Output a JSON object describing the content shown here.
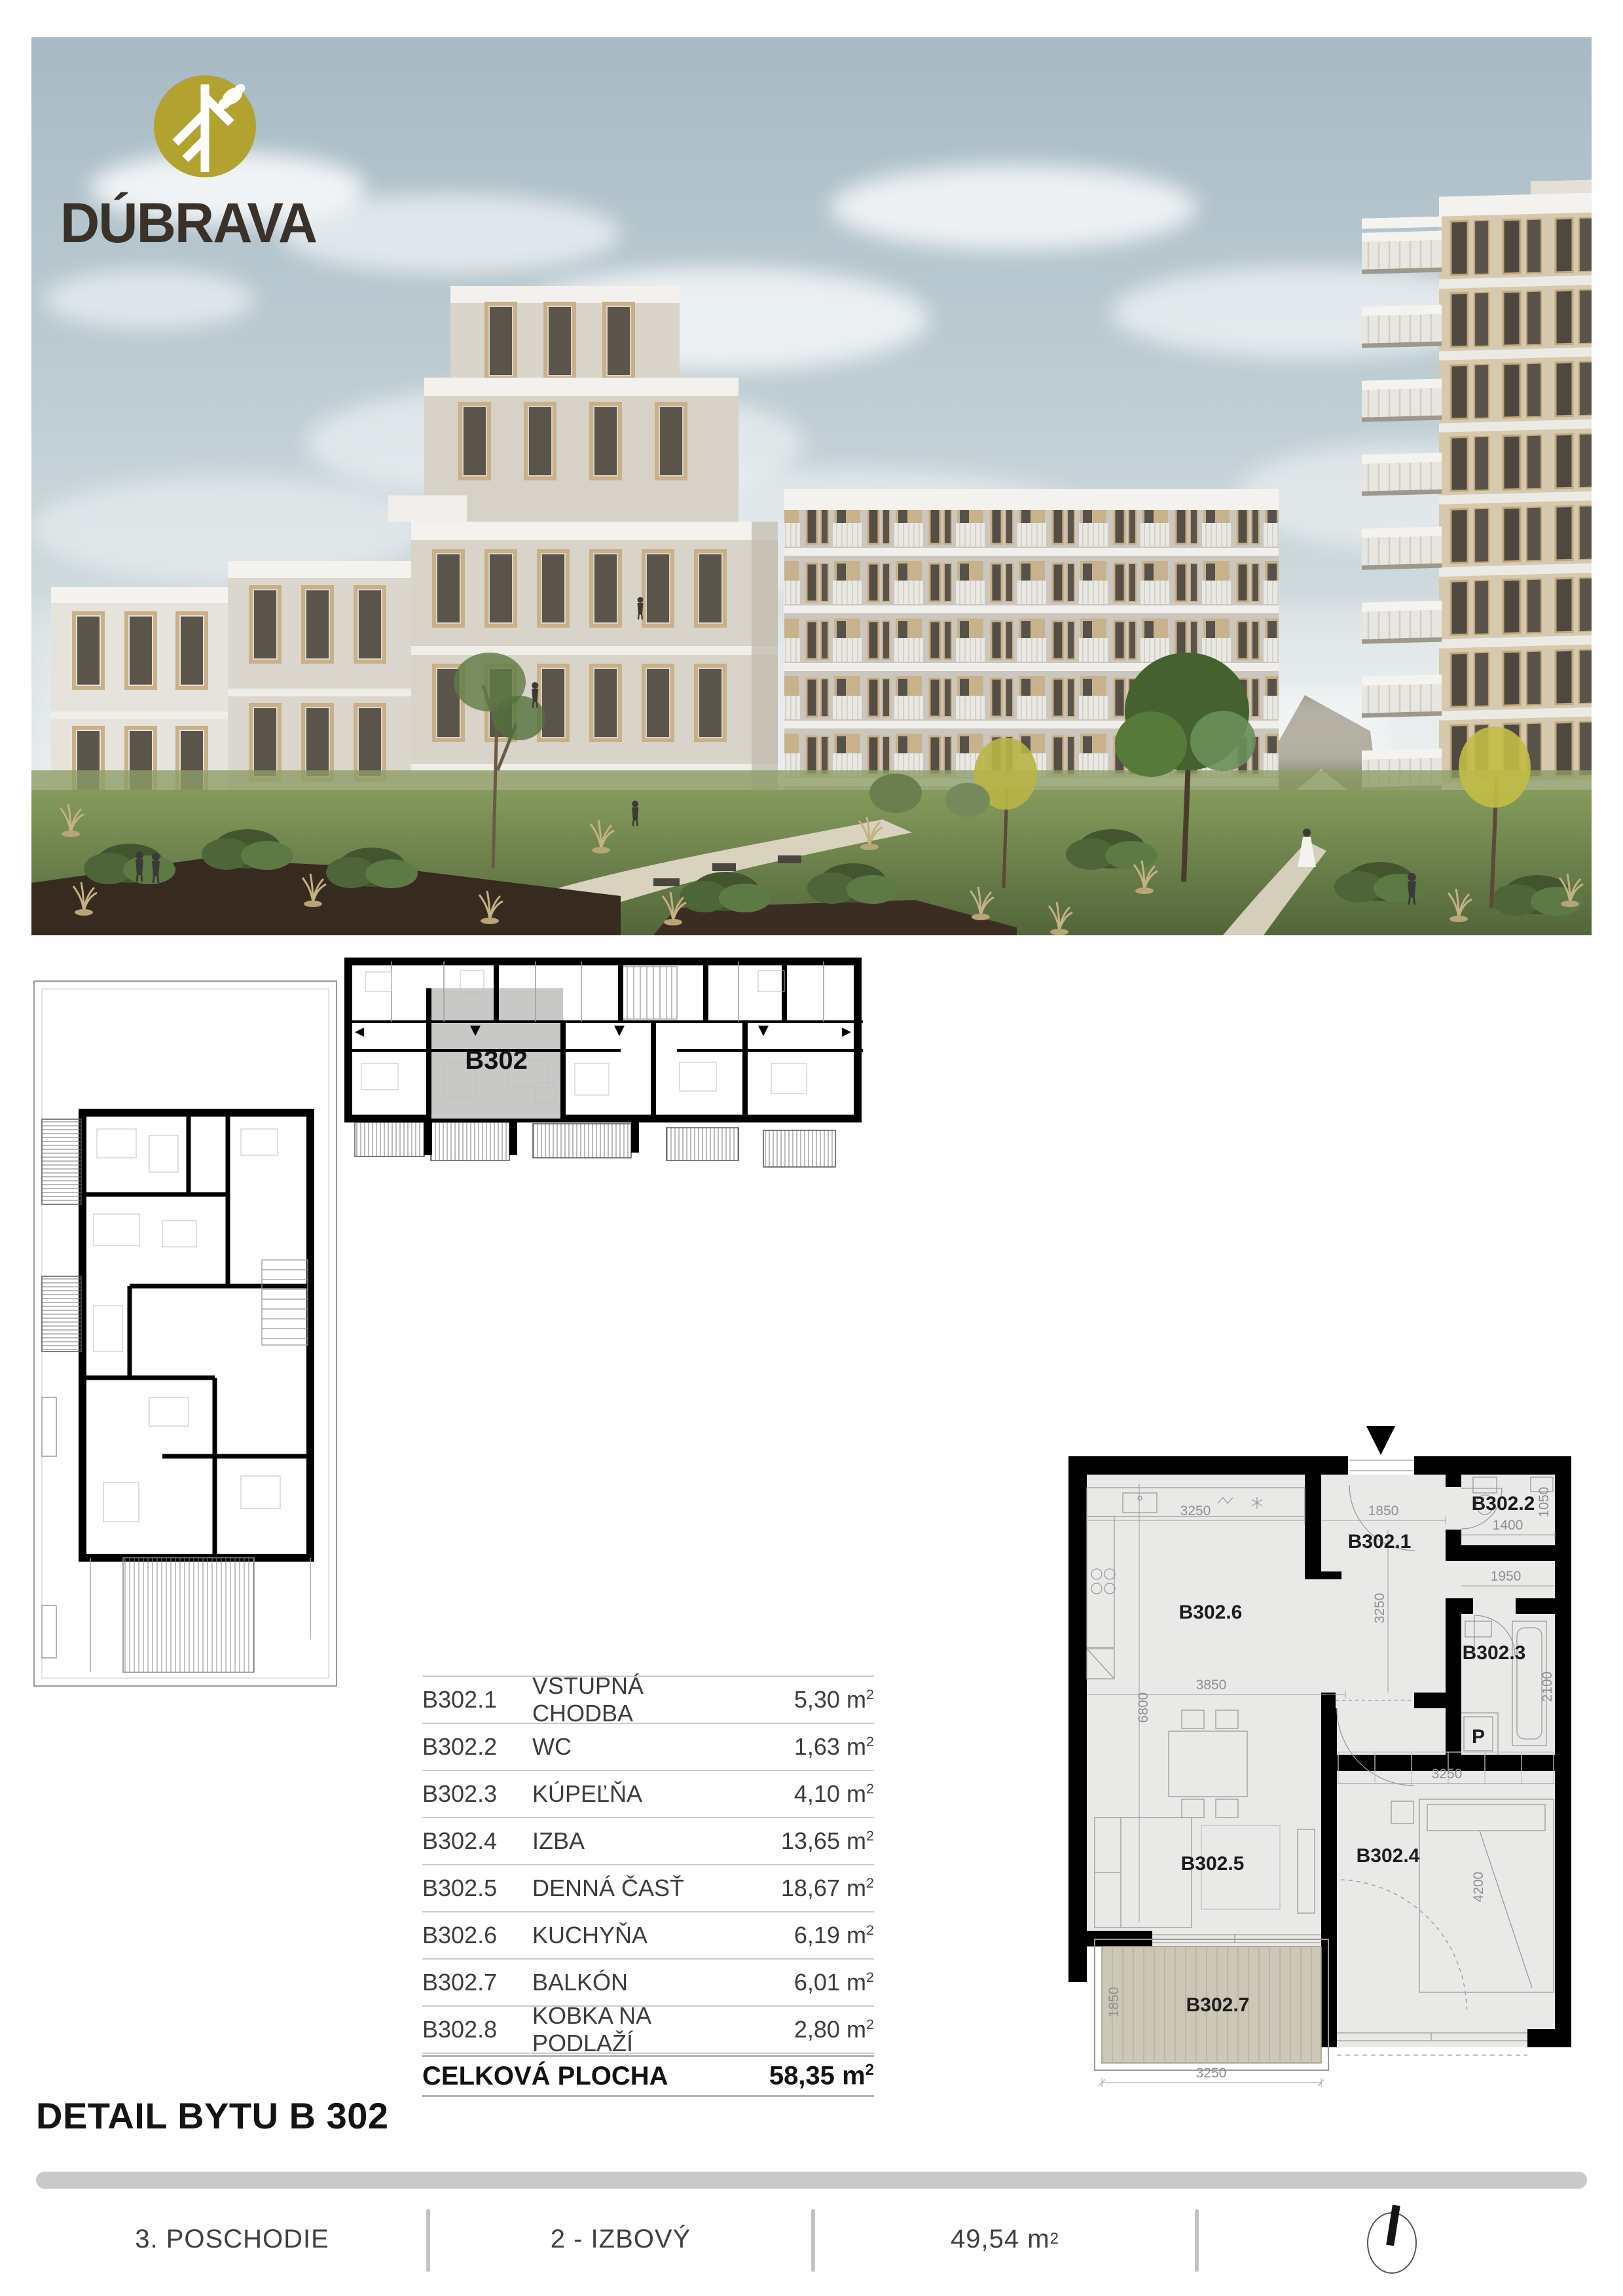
{
  "brand": {
    "name": "DÚBRAVA"
  },
  "units": {
    "m": "m",
    "exp": "2"
  },
  "rooms": [
    {
      "code": "B302.1",
      "name": "VSTUPNÁ CHODBA",
      "area": "5,30"
    },
    {
      "code": "B302.2",
      "name": "WC",
      "area": "1,63"
    },
    {
      "code": "B302.3",
      "name": "KÚPEĽŇA",
      "area": "4,10"
    },
    {
      "code": "B302.4",
      "name": "IZBA",
      "area": "13,65"
    },
    {
      "code": "B302.5",
      "name": "DENNÁ ČASŤ",
      "area": "18,67"
    },
    {
      "code": "B302.6",
      "name": "KUCHYŇA",
      "area": "6,19"
    },
    {
      "code": "B302.7",
      "name": "BALKÓN",
      "area": "6,01"
    },
    {
      "code": "B302.8",
      "name": "KOBKA NA PODLAŽÍ",
      "area": "2,80"
    }
  ],
  "total": {
    "label": "CELKOVÁ PLOCHA",
    "area": "58,35"
  },
  "title": "DETAIL BYTU B 302",
  "footer": {
    "floor": "3. POSCHODIE",
    "layout": "2 - IZBOVÝ",
    "area": "49,54"
  },
  "overview": {
    "unit_label": "B302"
  },
  "plan": {
    "labels": {
      "hall": "B302.1",
      "wc": "B302.2",
      "bath": "B302.3",
      "bedroom": "B302.4",
      "living": "B302.5",
      "kitchen": "B302.6",
      "balcony": "B302.7",
      "washer": "P"
    },
    "dims": {
      "kitchen_w": "3250",
      "hall_w": "1850",
      "wc_w": "1400",
      "wc_h": "1050",
      "hall_l": "3250",
      "corridor_w": "1950",
      "bath_h": "2100",
      "living_h": "6800",
      "living_w": "3850",
      "bedroom_w": "3250",
      "bedroom_h": "4200",
      "balcony_d": "1850",
      "balcony_w": "3250"
    }
  },
  "colors": {
    "accent": "#b2a230",
    "wall": "#000000",
    "floor": "#e9e9e7",
    "deck": "#cdc7b8",
    "bar": "#c9c9c9"
  }
}
